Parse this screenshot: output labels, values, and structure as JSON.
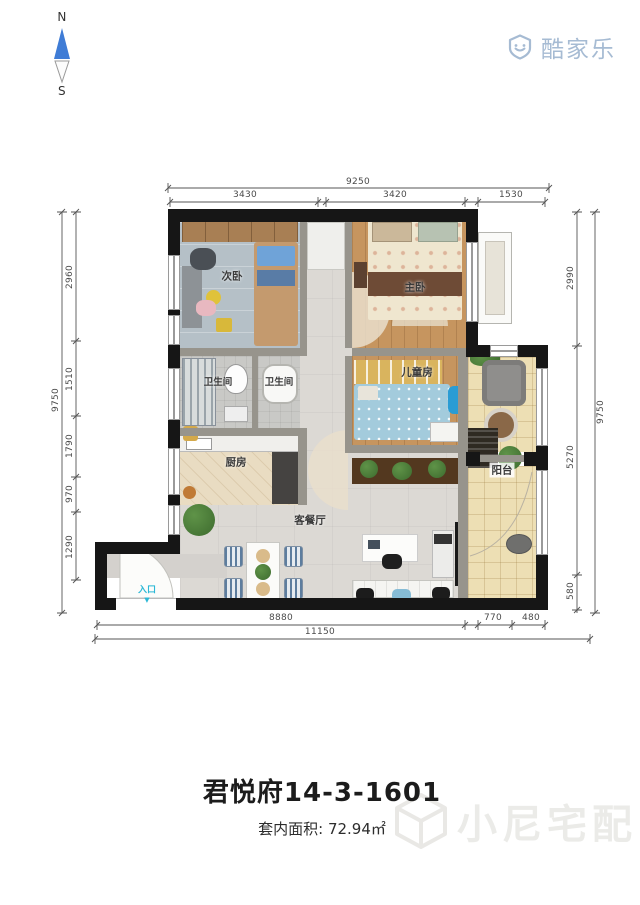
{
  "compass": {
    "north": "N",
    "south": "S"
  },
  "brand": {
    "name": "酷家乐"
  },
  "rooms": {
    "second_bedroom": "次卧",
    "master_bedroom": "主卧",
    "bath_left": "卫生间",
    "bath_right": "卫生间",
    "kitchen": "厨房",
    "kids_room": "儿童房",
    "balcony": "阳台",
    "living_dining": "客餐厅",
    "entrance": "入口"
  },
  "dims": {
    "top": {
      "total": "9250",
      "segs": [
        "3430",
        "3420",
        "1530"
      ]
    },
    "left": {
      "total": "9750",
      "segs": [
        "2960",
        "1510",
        "1790",
        "970",
        "1290"
      ]
    },
    "right": {
      "total": "9750",
      "segs": [
        "2990",
        "5270",
        "580"
      ]
    },
    "bottom": {
      "total": "11150",
      "segs": [
        "8880",
        "770",
        "480"
      ]
    }
  },
  "footer": {
    "title": "君悦府14-3-1601",
    "area_label": "套内面积:",
    "area_value": "72.94㎡"
  },
  "watermark": {
    "text": "小尼宅配"
  },
  "colors": {
    "wall": "#161616",
    "brand_blue": "#a6bbd3",
    "entrance_cyan": "#2cb8d6",
    "compass_needle": "#3f7cd6",
    "wood_floor": "#c6955f",
    "balcony_tile": "#eddfb4"
  }
}
